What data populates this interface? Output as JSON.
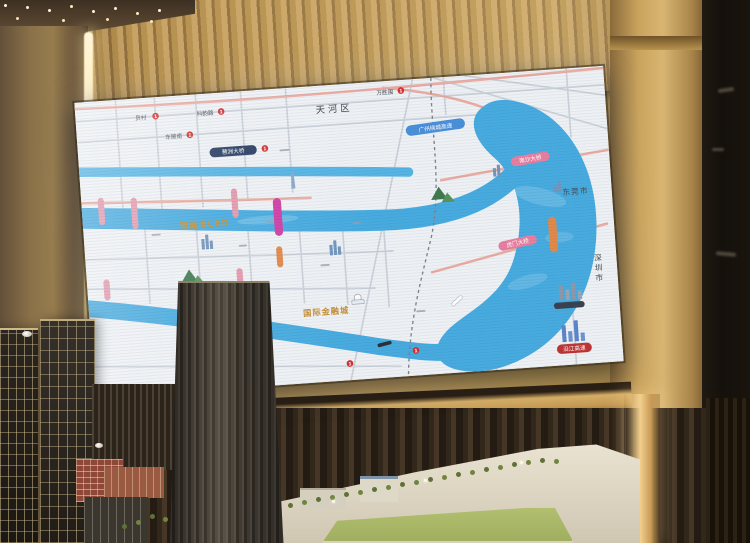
{
  "map": {
    "districts": {
      "tianhe": "天河区"
    },
    "cities": {
      "dongguan": "东莞市",
      "shenzhen": "深圳市"
    },
    "areas": {
      "pazhou_bay_cbd": "琶洲湾CBD",
      "intl_financial_city": "国际金融城"
    },
    "pills": {
      "ring_expressway": "广州绕城高速",
      "nansha_bridge": "南沙大桥",
      "humen_bridge": "虎门大桥",
      "riverside_expressway": "沿江高速",
      "pazhou_bridge": "琶洲大桥"
    },
    "stations": [
      "员村",
      "科韵路",
      "车陂南",
      "万胜围"
    ],
    "metro_badge": "1"
  },
  "colors": {
    "river_blue": "#47abdf",
    "map_background": "#eef1f4",
    "gold_label": "#c49038",
    "frame_gold": "#c89c53",
    "wall_wood": "#b6914f",
    "salmon_road": "#e9aca2",
    "blue_pill": "#4a90d9",
    "pink_pill": "#e77fa0",
    "red_pill": "#bf3434",
    "magenta_metro": "#cf3fa5",
    "model_tower": "#2e2922",
    "field_green": "#a8b868"
  }
}
